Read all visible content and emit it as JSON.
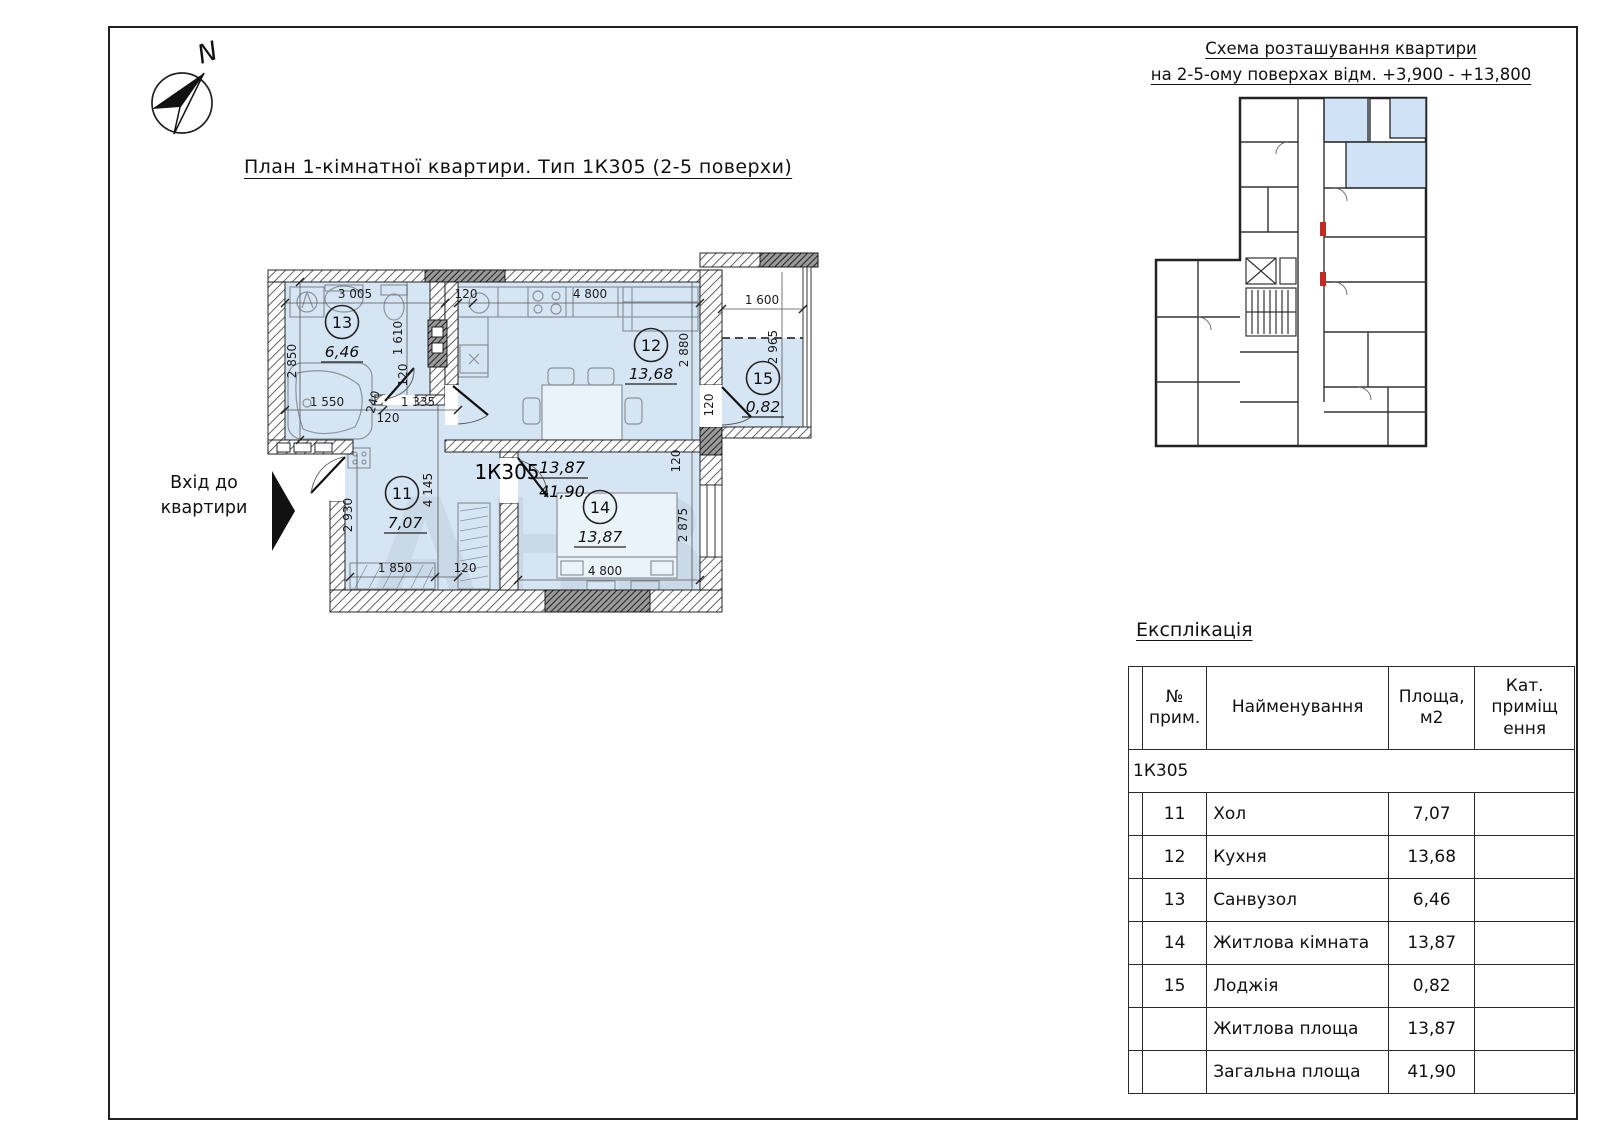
{
  "compass": {
    "north_label": "N"
  },
  "plan": {
    "title": "План 1-кімнатної квартири. Тип 1К305 (2-5 поверхи)",
    "entrance_line1": "Вхід до",
    "entrance_line2": "квартири",
    "apartment_code": "1К305",
    "fraction_top": "13,87",
    "fraction_bottom": "41,90",
    "watermark": "АНВ",
    "rooms": [
      {
        "number": "13",
        "area": "6,46"
      },
      {
        "number": "12",
        "area": "13,68"
      },
      {
        "number": "15",
        "area": "0,82"
      },
      {
        "number": "11",
        "area": "7,07"
      },
      {
        "number": "14",
        "area": "13,87"
      }
    ],
    "dims": {
      "bath_width": "3 005",
      "bath_height": "2 850",
      "bath_inner": "1 610",
      "tub": "1 550",
      "jog": "240",
      "corridor": "1 335",
      "kitchen_width": "4 800",
      "kitchen_height": "2 880",
      "loggia_width": "1 600",
      "loggia_height": "2 965",
      "hall_height": "2 930",
      "hall_inner": "4 145",
      "wardrobe": "1 850",
      "bed_width": "4 800",
      "bed_height": "2 875",
      "t120_1": "120",
      "t120_2": "120",
      "t120_3": "120",
      "t120_4": "120",
      "t120_5": "120",
      "t120_6": "120"
    }
  },
  "scheme": {
    "title_line1": "Схема розташування квартири",
    "title_line2": "на 2-5-ому поверхах відм. +3,900 - +13,800"
  },
  "explication": {
    "title": "Експлікація",
    "columns": [
      "№ прим.",
      "Найменування",
      "Площа, м2",
      "Кат. приміщ ення"
    ],
    "group_label": "1К305",
    "rows": [
      {
        "num": "11",
        "name": "Хол",
        "area": "7,07",
        "cat": ""
      },
      {
        "num": "12",
        "name": "Кухня",
        "area": "13,68",
        "cat": ""
      },
      {
        "num": "13",
        "name": "Санвузол",
        "area": "6,46",
        "cat": ""
      },
      {
        "num": "14",
        "name": "Житлова кімната",
        "area": "13,87",
        "cat": ""
      },
      {
        "num": "15",
        "name": "Лоджія",
        "area": "0,82",
        "cat": ""
      },
      {
        "num": "",
        "name": "Житлова площа",
        "area": "13,87",
        "cat": ""
      },
      {
        "num": "",
        "name": "Загальна площа",
        "area": "41,90",
        "cat": ""
      }
    ]
  }
}
